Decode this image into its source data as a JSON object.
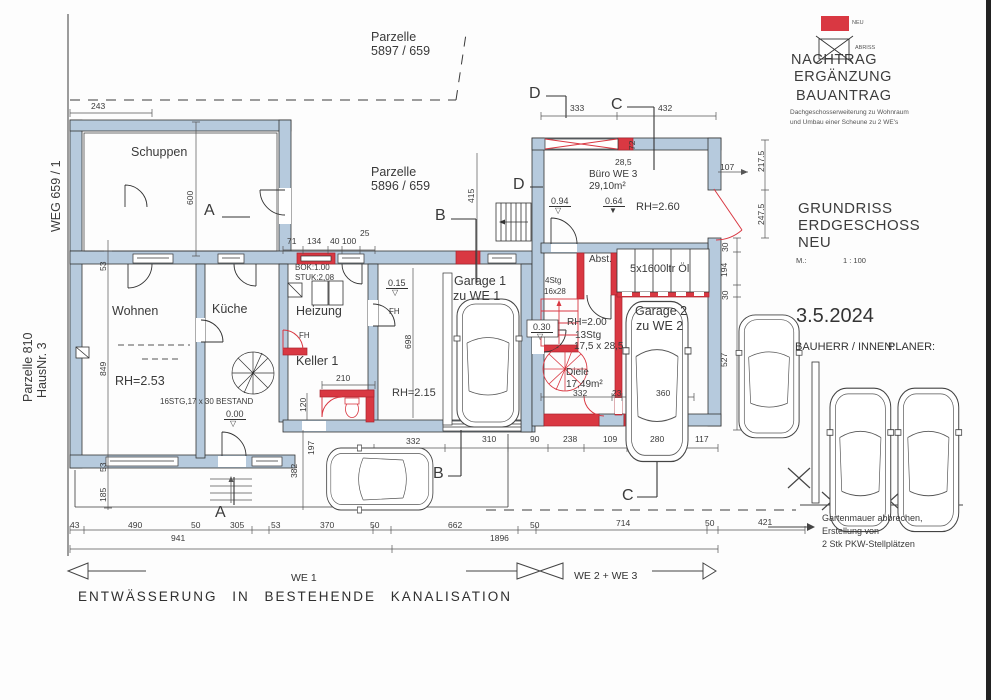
{
  "colors": {
    "wall": "#b6cadd",
    "neu": "#d93842",
    "line": "#333333",
    "dim": "#555555"
  },
  "legend": {
    "neu_label": "NEU",
    "abriss_label": "ABRISS"
  },
  "title_block": {
    "line1": "NACHTRAG",
    "line2": "ERGÄNZUNG",
    "line3": "BAUANTRAG",
    "subtitle1": "Dachgeschosserweiterung zu Wohnraum",
    "subtitle2": "und Umbau einer Scheune zu 2 WE's",
    "drawing_title1": "GRUNDRISS",
    "drawing_title2": "ERDGESCHOSS",
    "drawing_title3": "NEU",
    "scale_label": "M.:",
    "scale_value": "1 : 100",
    "date": "3.5.2024",
    "bauherr_label": "BAUHERR / INNEN:",
    "planer_label": "PLANER:"
  },
  "notes": {
    "garden1": "Gartenmauer abbrechen,",
    "garden2": "Erstellung von",
    "garden3": "2 Stk PKW-Stellplätzen",
    "drainage": "ENTWÄSSERUNG IN BESTEHENDE KANALISATION",
    "we1": "WE 1",
    "we23": "WE 2 + WE 3"
  },
  "plan_labels": [
    {
      "t": "Parzelle",
      "x": 371,
      "y": 31,
      "c": "m",
      "n": "parcel-5897-label"
    },
    {
      "t": "5897 / 659",
      "x": 371,
      "y": 45,
      "c": "m",
      "n": "parcel-5897-number"
    },
    {
      "t": "Parzelle",
      "x": 371,
      "y": 166,
      "c": "m",
      "n": "parcel-5896-label"
    },
    {
      "t": "5896 / 659",
      "x": 371,
      "y": 180,
      "c": "m",
      "n": "parcel-5896-number"
    },
    {
      "t": "WEG 659 / 1",
      "x": 50,
      "y": 232,
      "c": "m",
      "r": 1,
      "n": "weg-label"
    },
    {
      "t": "Parzelle 810",
      "x": 22,
      "y": 402,
      "c": "m",
      "r": 1,
      "n": "parcel-810-label"
    },
    {
      "t": "HausNr. 3",
      "x": 36,
      "y": 398,
      "c": "m",
      "r": 1,
      "n": "hausnr-label"
    },
    {
      "t": "Schuppen",
      "x": 131,
      "y": 146,
      "c": "m",
      "n": "room-schuppen"
    },
    {
      "t": "Wohnen",
      "x": 112,
      "y": 305,
      "c": "m",
      "n": "room-wohnen"
    },
    {
      "t": "RH=2.53",
      "x": 115,
      "y": 375,
      "c": "m",
      "n": "rh-wohnen"
    },
    {
      "t": "Küche",
      "x": 212,
      "y": 303,
      "c": "m",
      "n": "room-kueche"
    },
    {
      "t": "Heizung",
      "x": 296,
      "y": 305,
      "c": "m",
      "n": "room-heizung"
    },
    {
      "t": "Keller 1",
      "x": 296,
      "y": 355,
      "c": "m",
      "n": "room-keller"
    },
    {
      "t": "Garage 1",
      "x": 454,
      "y": 275,
      "c": "m",
      "n": "room-garage1"
    },
    {
      "t": "zu WE 1",
      "x": 453,
      "y": 290,
      "c": "m",
      "n": "room-garage1-we"
    },
    {
      "t": "Büro WE 3",
      "x": 589,
      "y": 170,
      "c": "s10",
      "n": "room-buero"
    },
    {
      "t": "29,10m²",
      "x": 589,
      "y": 182,
      "c": "s10",
      "n": "room-buero-area"
    },
    {
      "t": "RH=2.60",
      "x": 636,
      "y": 202,
      "c": "s11",
      "n": "rh-buero"
    },
    {
      "t": "Abst.",
      "x": 589,
      "y": 255,
      "c": "s10",
      "n": "room-abst"
    },
    {
      "t": "5x1600ltr Öl",
      "x": 630,
      "y": 264,
      "c": "s11",
      "n": "oil-tanks-label"
    },
    {
      "t": "Garage 2",
      "x": 635,
      "y": 305,
      "c": "m",
      "n": "room-garage2"
    },
    {
      "t": "zu WE 2",
      "x": 636,
      "y": 320,
      "c": "m",
      "n": "room-garage2-we"
    },
    {
      "t": "RH=2.00",
      "x": 567,
      "y": 318,
      "c": "s10",
      "n": "rh-diele"
    },
    {
      "t": "Diele",
      "x": 566,
      "y": 368,
      "c": "s10",
      "n": "room-diele"
    },
    {
      "t": "17,49m²",
      "x": 566,
      "y": 380,
      "c": "s10",
      "n": "room-diele-area"
    },
    {
      "t": "RH=2.15",
      "x": 392,
      "y": 388,
      "c": "s11",
      "n": "rh-garage1"
    },
    {
      "t": "16STG,17 x 30 BESTAND",
      "x": 160,
      "y": 398,
      "c": "xs",
      "n": "stair-bestand-label"
    },
    {
      "t": "BOK:1.00",
      "x": 295,
      "y": 264,
      "c": "xs",
      "n": "bok-label"
    },
    {
      "t": "STUK:2,08",
      "x": 295,
      "y": 274,
      "c": "xs",
      "n": "stuk-label"
    },
    {
      "t": "FH",
      "x": 299,
      "y": 332,
      "c": "xs",
      "n": "fh-label-1"
    },
    {
      "t": "FH",
      "x": 389,
      "y": 308,
      "c": "xs",
      "n": "fh-label-2"
    },
    {
      "t": "4Stg",
      "x": 545,
      "y": 277,
      "c": "xs red",
      "n": "stair-4stg-label"
    },
    {
      "t": "16x28",
      "x": 544,
      "y": 288,
      "c": "xs red",
      "n": "stair-4stg-size"
    },
    {
      "t": "13Stg",
      "x": 575,
      "y": 331,
      "c": "s10 red",
      "n": "stair-13stg-label"
    },
    {
      "t": "17,5 x 28,5",
      "x": 574,
      "y": 342,
      "c": "s10 red",
      "n": "stair-13stg-size"
    },
    {
      "t": "0.00",
      "x": 224,
      "y": 410,
      "c": "lvl",
      "n": "level-000"
    },
    {
      "t": "0.15",
      "x": 386,
      "y": 279,
      "c": "lvl",
      "n": "level-015"
    },
    {
      "t": "0.94",
      "x": 549,
      "y": 197,
      "c": "lvl",
      "n": "level-094"
    },
    {
      "t": "0.64",
      "x": 603,
      "y": 197,
      "c": "lvl",
      "n": "level-064"
    },
    {
      "t": "0.30",
      "x": 531,
      "y": 323,
      "c": "lvl",
      "n": "level-030"
    },
    {
      "t": "▽",
      "x": 230,
      "y": 420,
      "c": "tri",
      "n": "level-000-triangle"
    },
    {
      "t": "▽",
      "x": 392,
      "y": 289,
      "c": "tri",
      "n": "level-015-triangle"
    },
    {
      "t": "▽",
      "x": 555,
      "y": 207,
      "c": "tri",
      "n": "level-094-triangle"
    },
    {
      "t": "▼",
      "x": 609,
      "y": 207,
      "c": "tri",
      "n": "level-064-triangle"
    },
    {
      "t": "▽",
      "x": 537,
      "y": 333,
      "c": "tri",
      "n": "level-030-triangle"
    },
    {
      "t": "A",
      "x": 204,
      "y": 203,
      "c": "sec",
      "n": "section-a-top"
    },
    {
      "t": "A",
      "x": 215,
      "y": 505,
      "c": "sec",
      "n": "section-a-bottom"
    },
    {
      "t": "B",
      "x": 435,
      "y": 208,
      "c": "sec",
      "n": "section-b-top"
    },
    {
      "t": "B",
      "x": 433,
      "y": 466,
      "c": "sec",
      "n": "section-b-bottom"
    },
    {
      "t": "C",
      "x": 611,
      "y": 97,
      "c": "sec",
      "n": "section-c-top"
    },
    {
      "t": "C",
      "x": 622,
      "y": 488,
      "c": "sec",
      "n": "section-c-bottom"
    },
    {
      "t": "D",
      "x": 529,
      "y": 86,
      "c": "sec",
      "n": "section-d-top"
    },
    {
      "t": "D",
      "x": 513,
      "y": 177,
      "c": "sec",
      "n": "section-d-mid"
    },
    {
      "t": "243",
      "x": 91,
      "y": 102,
      "c": "d"
    },
    {
      "t": "71",
      "x": 287,
      "y": 237,
      "c": "d"
    },
    {
      "t": "134",
      "x": 307,
      "y": 237,
      "c": "d"
    },
    {
      "t": "40",
      "x": 330,
      "y": 237,
      "c": "d"
    },
    {
      "t": "100",
      "x": 342,
      "y": 237,
      "c": "d"
    },
    {
      "t": "25",
      "x": 360,
      "y": 229,
      "c": "d"
    },
    {
      "t": "210",
      "x": 336,
      "y": 374,
      "c": "d"
    },
    {
      "t": "333",
      "x": 570,
      "y": 104,
      "c": "d"
    },
    {
      "t": "432",
      "x": 658,
      "y": 104,
      "c": "d"
    },
    {
      "t": "28,5",
      "x": 615,
      "y": 158,
      "c": "d"
    },
    {
      "t": "107",
      "x": 720,
      "y": 163,
      "c": "d"
    },
    {
      "t": "332",
      "x": 406,
      "y": 437,
      "c": "d"
    },
    {
      "t": "310",
      "x": 482,
      "y": 435,
      "c": "d"
    },
    {
      "t": "90",
      "x": 530,
      "y": 435,
      "c": "d"
    },
    {
      "t": "238",
      "x": 563,
      "y": 435,
      "c": "d"
    },
    {
      "t": "109",
      "x": 603,
      "y": 435,
      "c": "d"
    },
    {
      "t": "280",
      "x": 650,
      "y": 435,
      "c": "d"
    },
    {
      "t": "117",
      "x": 695,
      "y": 435,
      "c": "d"
    },
    {
      "t": "332",
      "x": 573,
      "y": 389,
      "c": "d"
    },
    {
      "t": "23",
      "x": 612,
      "y": 389,
      "c": "d"
    },
    {
      "t": "360",
      "x": 656,
      "y": 389,
      "c": "d"
    },
    {
      "t": "43",
      "x": 70,
      "y": 521,
      "c": "d"
    },
    {
      "t": "490",
      "x": 128,
      "y": 521,
      "c": "d"
    },
    {
      "t": "50",
      "x": 191,
      "y": 521,
      "c": "d"
    },
    {
      "t": "305",
      "x": 230,
      "y": 521,
      "c": "d"
    },
    {
      "t": "53",
      "x": 271,
      "y": 521,
      "c": "d"
    },
    {
      "t": "370",
      "x": 320,
      "y": 521,
      "c": "d"
    },
    {
      "t": "50",
      "x": 370,
      "y": 521,
      "c": "d"
    },
    {
      "t": "662",
      "x": 448,
      "y": 521,
      "c": "d"
    },
    {
      "t": "50",
      "x": 530,
      "y": 521,
      "c": "d"
    },
    {
      "t": "714",
      "x": 616,
      "y": 519,
      "c": "d"
    },
    {
      "t": "50",
      "x": 705,
      "y": 519,
      "c": "d"
    },
    {
      "t": "421",
      "x": 758,
      "y": 518,
      "c": "d"
    },
    {
      "t": "941",
      "x": 171,
      "y": 534,
      "c": "d"
    },
    {
      "t": "1896",
      "x": 490,
      "y": 534,
      "c": "d"
    },
    {
      "t": "600",
      "x": 186,
      "y": 205,
      "c": "d",
      "r": 1
    },
    {
      "t": "53",
      "x": 99,
      "y": 271,
      "c": "d",
      "r": 1
    },
    {
      "t": "849",
      "x": 99,
      "y": 376,
      "c": "d",
      "r": 1
    },
    {
      "t": "53",
      "x": 99,
      "y": 472,
      "c": "d",
      "r": 1
    },
    {
      "t": "185",
      "x": 99,
      "y": 502,
      "c": "d",
      "r": 1
    },
    {
      "t": "415",
      "x": 467,
      "y": 203,
      "c": "d",
      "r": 1
    },
    {
      "t": "698",
      "x": 404,
      "y": 349,
      "c": "d",
      "r": 1
    },
    {
      "t": "120",
      "x": 299,
      "y": 412,
      "c": "d",
      "r": 1
    },
    {
      "t": "72",
      "x": 628,
      "y": 150,
      "c": "d",
      "r": 1
    },
    {
      "t": "217.5",
      "x": 757,
      "y": 172,
      "c": "d",
      "r": 1
    },
    {
      "t": "247.5",
      "x": 757,
      "y": 225,
      "c": "d",
      "r": 1
    },
    {
      "t": "30",
      "x": 721,
      "y": 252,
      "c": "d",
      "r": 1
    },
    {
      "t": "194",
      "x": 720,
      "y": 277,
      "c": "d",
      "r": 1
    },
    {
      "t": "30",
      "x": 721,
      "y": 300,
      "c": "d",
      "r": 1
    },
    {
      "t": "527",
      "x": 720,
      "y": 367,
      "c": "d",
      "r": 1
    },
    {
      "t": "382",
      "x": 290,
      "y": 478,
      "c": "d",
      "r": 1
    },
    {
      "t": "197",
      "x": 307,
      "y": 455,
      "c": "d",
      "r": 1
    }
  ]
}
